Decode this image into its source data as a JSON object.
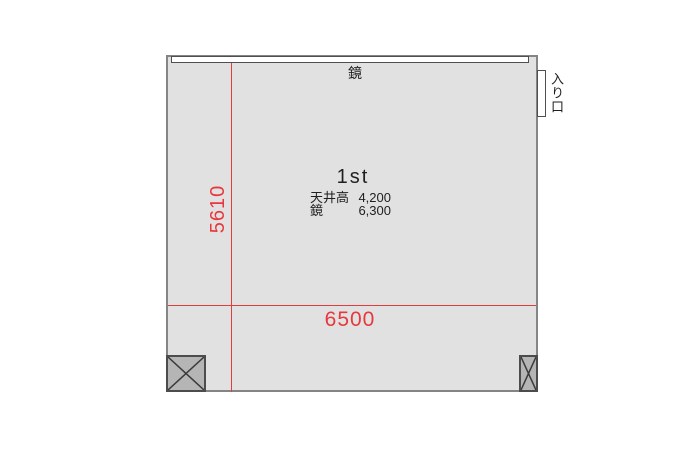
{
  "floorplan": {
    "room_name": "1st",
    "mirror_label": "鏡",
    "entrance_label": "入り口",
    "specs": [
      {
        "label": "天井高",
        "value": "4,200"
      },
      {
        "label": "鏡",
        "value": "6,300"
      }
    ],
    "dimensions": {
      "width": "6500",
      "depth": "5610"
    },
    "colors": {
      "room_fill": "#e1e1e1",
      "wall": "#858585",
      "dimension_red": "#e8383d",
      "pillar_fill": "#b5b5b5",
      "pillar_border": "#4c4c4c",
      "text": "#1f1f1f"
    }
  }
}
